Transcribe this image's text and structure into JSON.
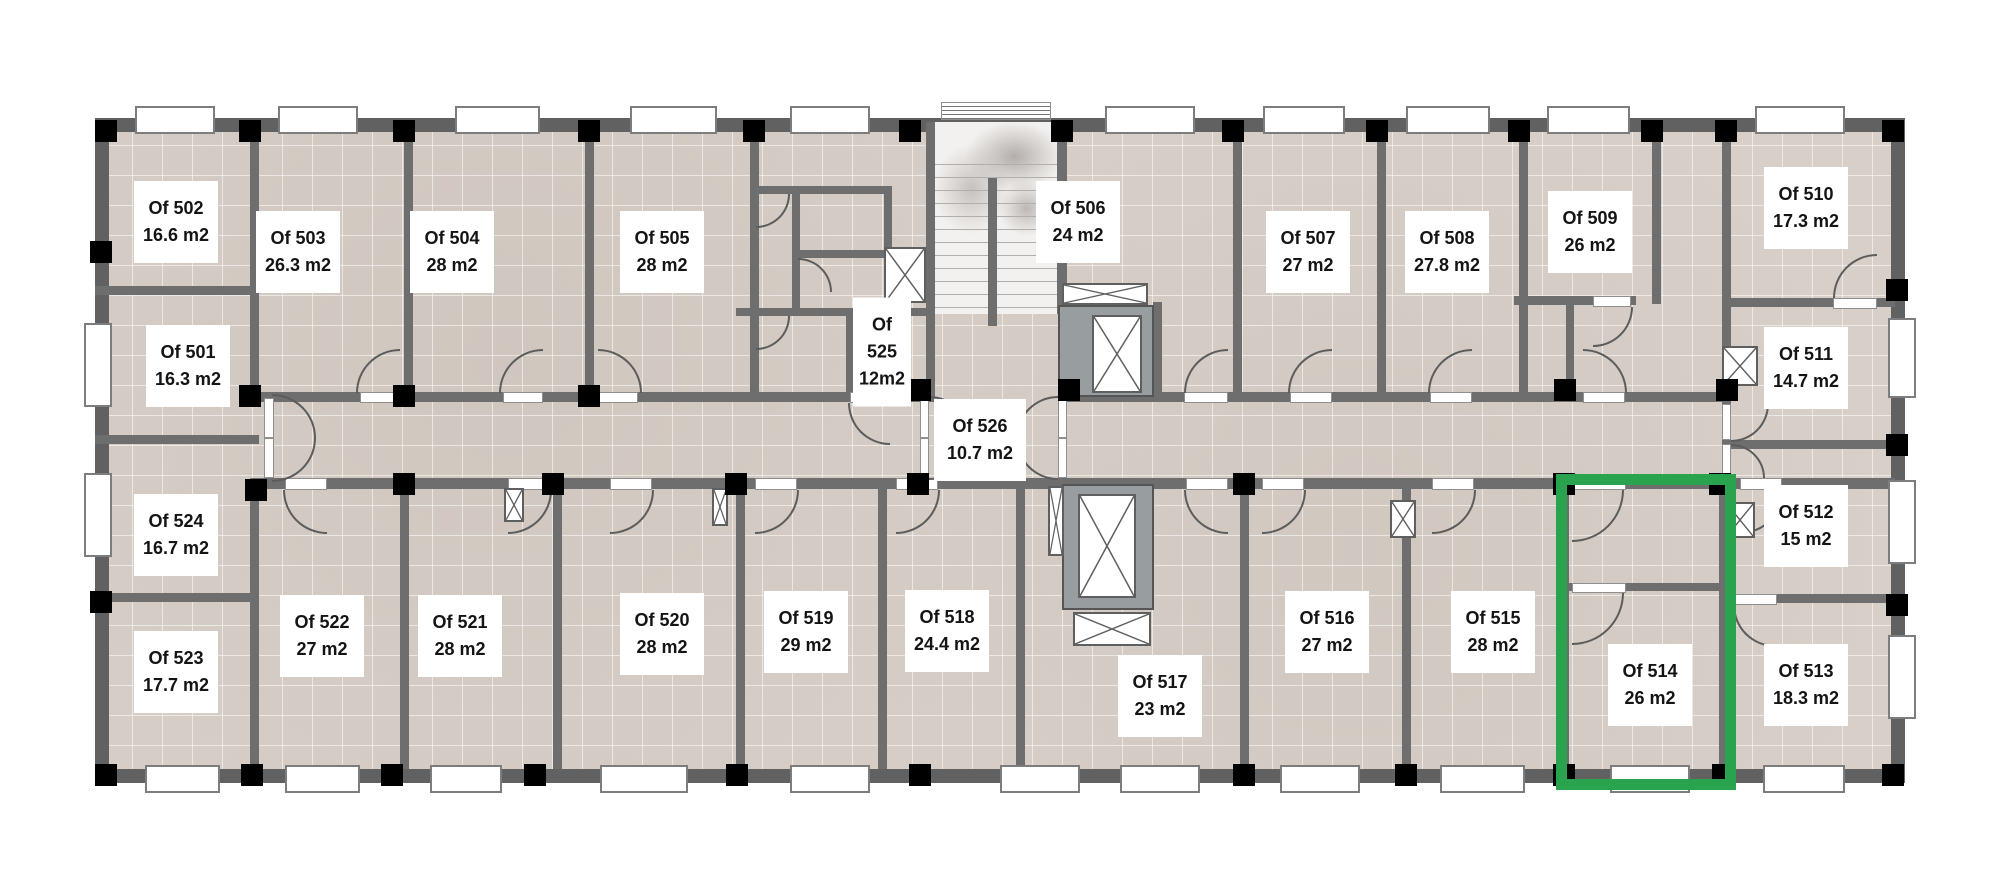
{
  "plan": {
    "highlight_color": "#2aa34e",
    "highlighted_room": "Of 514",
    "area_unit": "m2",
    "rooms": [
      {
        "id": "Of 502",
        "area": "16.6 m2"
      },
      {
        "id": "Of 503",
        "area": "26.3 m2"
      },
      {
        "id": "Of 504",
        "area": "28 m2"
      },
      {
        "id": "Of 505",
        "area": "28 m2"
      },
      {
        "id": "Of 506",
        "area": "24 m2"
      },
      {
        "id": "Of 507",
        "area": "27 m2"
      },
      {
        "id": "Of 508",
        "area": "27.8 m2"
      },
      {
        "id": "Of 509",
        "area": "26 m2"
      },
      {
        "id": "Of 510",
        "area": "17.3 m2"
      },
      {
        "id": "Of 511",
        "area": "14.7 m2"
      },
      {
        "id": "Of 501",
        "area": "16.3 m2"
      },
      {
        "id": "Of 525",
        "area": "12m2"
      },
      {
        "id": "Of 526",
        "area": "10.7 m2"
      },
      {
        "id": "Of 512",
        "area": "15 m2"
      },
      {
        "id": "Of 524",
        "area": "16.7 m2"
      },
      {
        "id": "Of 523",
        "area": "17.7 m2"
      },
      {
        "id": "Of 522",
        "area": "27 m2"
      },
      {
        "id": "Of 521",
        "area": "28 m2"
      },
      {
        "id": "Of 520",
        "area": "28 m2"
      },
      {
        "id": "Of 519",
        "area": "29 m2"
      },
      {
        "id": "Of 518",
        "area": "24.4 m2"
      },
      {
        "id": "Of 517",
        "area": "23 m2"
      },
      {
        "id": "Of 516",
        "area": "27 m2"
      },
      {
        "id": "Of 515",
        "area": "28 m2"
      },
      {
        "id": "Of 514",
        "area": "26 m2",
        "highlighted": true
      },
      {
        "id": "Of 513",
        "area": "18.3 m2"
      }
    ]
  }
}
